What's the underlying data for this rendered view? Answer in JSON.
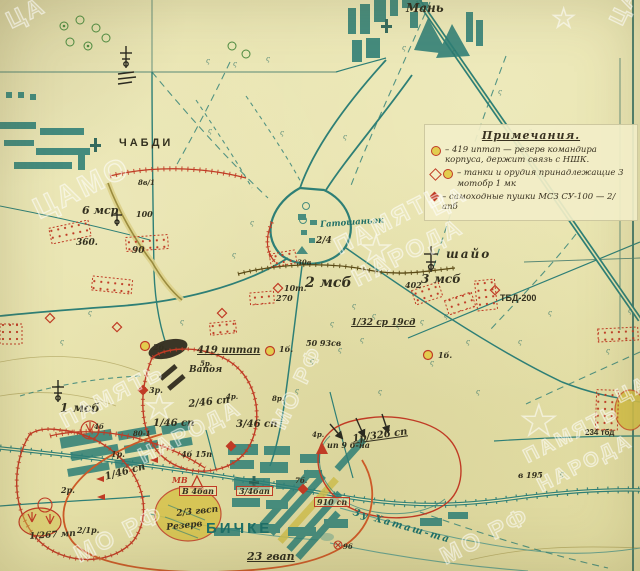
{
  "palette": {
    "dark": "#33301f",
    "teal": "#1e6e66",
    "red": "#c03b25",
    "orange": "#cc5a28",
    "brown": "#5a4a16",
    "paper": "#e8e3ac"
  },
  "legend": {
    "title": "Примечания.",
    "items": [
      {
        "symbols": [
          "sym-circle-yellow"
        ],
        "text": "– 419 иптап — резерв командира корпуса, держит связь с НШК."
      },
      {
        "symbols": [
          "sym-diamond-hollow",
          "sym-circle-yellow"
        ],
        "text": "– танки и орудия принадлежащие 3 мотобр 1 мк"
      },
      {
        "symbols": [
          "sym-diamond-solid"
        ],
        "text": "– самоходные пушки МСЗ СУ-100 — 2/апб"
      }
    ]
  },
  "labels": [
    {
      "text": "Мань",
      "x": 406,
      "y": 2,
      "size": 12,
      "color": "dark",
      "name": "town-label-man"
    },
    {
      "text": "ЧАБДИ",
      "x": 119,
      "y": 138,
      "size": 11,
      "color": "dark",
      "cls": "lab-print",
      "spacing": 3,
      "name": "town-label-chabdi"
    },
    {
      "text": "8в/1",
      "x": 138,
      "y": 179,
      "size": 7,
      "color": "dark"
    },
    {
      "text": "6 мср",
      "x": 82,
      "y": 205,
      "size": 11,
      "color": "dark",
      "name": "unit-label-6msr"
    },
    {
      "text": "100",
      "x": 136,
      "y": 210,
      "size": 8,
      "color": "dark"
    },
    {
      "text": "360.",
      "x": 76,
      "y": 239,
      "size": 9,
      "color": "dark"
    },
    {
      "text": "90",
      "x": 132,
      "y": 247,
      "size": 9,
      "color": "dark"
    },
    {
      "text": "Гатошаньэк",
      "x": 320,
      "y": 221,
      "size": 8.5,
      "color": "teal",
      "rotate": -4,
      "name": "town-label-gatoshanek"
    },
    {
      "text": "2/4",
      "x": 316,
      "y": 237,
      "size": 9,
      "color": "dark"
    },
    {
      "text": "шайо",
      "x": 446,
      "y": 248,
      "size": 12,
      "color": "dark",
      "spacing": 2,
      "name": "town-label-shayo"
    },
    {
      "text": "3 мсб",
      "x": 421,
      "y": 273,
      "size": 12,
      "color": "dark",
      "name": "unit-label-3msb"
    },
    {
      "text": "402",
      "x": 405,
      "y": 281,
      "size": 8,
      "color": "dark"
    },
    {
      "text": "ТБД-200",
      "x": 500,
      "y": 294,
      "size": 9,
      "color": "dark",
      "cls": "lab-print"
    },
    {
      "text": "2 мсб",
      "x": 305,
      "y": 276,
      "size": 14,
      "color": "dark",
      "name": "unit-label-2msb"
    },
    {
      "text": "10т.",
      "x": 284,
      "y": 284,
      "size": 8,
      "color": "dark"
    },
    {
      "text": "270",
      "x": 276,
      "y": 294,
      "size": 8,
      "color": "dark"
    },
    {
      "text": "30в",
      "x": 297,
      "y": 259,
      "size": 7,
      "color": "dark"
    },
    {
      "text": "1/32 ср 19сд",
      "x": 351,
      "y": 319,
      "size": 9,
      "color": "dark",
      "underline": true
    },
    {
      "text": "50 93св",
      "x": 306,
      "y": 339,
      "size": 8,
      "color": "dark"
    },
    {
      "text": "419 иптап",
      "x": 197,
      "y": 346,
      "size": 10,
      "color": "dark",
      "underline": true,
      "name": "unit-label-419iptap"
    },
    {
      "text": "2б.",
      "x": 153,
      "y": 343,
      "size": 8,
      "color": "dark"
    },
    {
      "text": "1б.",
      "x": 279,
      "y": 345,
      "size": 8,
      "color": "dark"
    },
    {
      "text": "1б.",
      "x": 438,
      "y": 351,
      "size": 8,
      "color": "dark"
    },
    {
      "text": "Вапоя",
      "x": 189,
      "y": 366,
      "size": 9,
      "color": "dark"
    },
    {
      "text": "3р.",
      "x": 149,
      "y": 386,
      "size": 8,
      "color": "dark"
    },
    {
      "text": "5р.",
      "x": 200,
      "y": 360,
      "size": 7,
      "color": "dark"
    },
    {
      "text": "4р.",
      "x": 226,
      "y": 393,
      "size": 7,
      "color": "dark"
    },
    {
      "text": "8р.",
      "x": 272,
      "y": 395,
      "size": 7,
      "color": "dark"
    },
    {
      "text": "1 мсб",
      "x": 60,
      "y": 402,
      "size": 12,
      "color": "dark",
      "name": "unit-label-1msb"
    },
    {
      "text": "4б",
      "x": 94,
      "y": 423,
      "size": 7,
      "color": "dark"
    },
    {
      "text": "80-1",
      "x": 133,
      "y": 430,
      "size": 7,
      "color": "dark"
    },
    {
      "text": "1р.",
      "x": 111,
      "y": 450,
      "size": 8,
      "color": "dark"
    },
    {
      "text": "2/46 сп",
      "x": 188,
      "y": 400,
      "size": 10,
      "color": "dark",
      "rotate": -6
    },
    {
      "text": "1/46 сп",
      "x": 153,
      "y": 419,
      "size": 10,
      "color": "dark"
    },
    {
      "text": "3/46 сп",
      "x": 236,
      "y": 420,
      "size": 10,
      "color": "dark"
    },
    {
      "text": "4б 15п",
      "x": 181,
      "y": 450,
      "size": 8,
      "color": "dark"
    },
    {
      "text": "4р.",
      "x": 312,
      "y": 431,
      "size": 7,
      "color": "dark"
    },
    {
      "text": "ип 9 б-на",
      "x": 327,
      "y": 441,
      "size": 8,
      "color": "dark"
    },
    {
      "text": "1р/326 сп",
      "x": 352,
      "y": 435,
      "size": 10,
      "color": "dark",
      "rotate": -8,
      "underline": true
    },
    {
      "text": "7б.",
      "x": 295,
      "y": 477,
      "size": 7,
      "color": "dark"
    },
    {
      "text": "МВ",
      "x": 172,
      "y": 476,
      "size": 8,
      "color": "red"
    },
    {
      "text": "В 4бап",
      "x": 179,
      "y": 486,
      "size": 8,
      "color": "dark",
      "boxed": true
    },
    {
      "text": "3/4бап",
      "x": 236,
      "y": 486,
      "size": 8,
      "color": "dark",
      "boxed": true
    },
    {
      "text": "910 сп",
      "x": 314,
      "y": 497,
      "size": 8,
      "color": "dark",
      "boxed": true
    },
    {
      "text": "2/3 гвсп",
      "x": 176,
      "y": 510,
      "size": 9,
      "color": "dark",
      "rotate": -6
    },
    {
      "text": "Резерв",
      "x": 166,
      "y": 524,
      "size": 9,
      "color": "dark",
      "rotate": -6
    },
    {
      "text": "БИЧКЕ",
      "x": 206,
      "y": 521,
      "size": 15,
      "color": "teal",
      "cls": "lab-print",
      "spacing": 3,
      "name": "town-label-bicske"
    },
    {
      "text": "23 гвап",
      "x": 247,
      "y": 551,
      "size": 11,
      "color": "dark",
      "underline": true,
      "name": "unit-label-23gvap"
    },
    {
      "text": "1/46 сп",
      "x": 104,
      "y": 473,
      "size": 10,
      "color": "dark",
      "rotate": -15
    },
    {
      "text": "2р.",
      "x": 61,
      "y": 486,
      "size": 8,
      "color": "dark"
    },
    {
      "text": "2/1р.",
      "x": 77,
      "y": 526,
      "size": 8,
      "color": "dark"
    },
    {
      "text": "1/267 мп",
      "x": 29,
      "y": 533,
      "size": 9,
      "color": "dark",
      "rotate": -4,
      "name": "unit-label-267mp"
    },
    {
      "text": "Зу Хаташ-та",
      "x": 354,
      "y": 508,
      "size": 10,
      "color": "teal",
      "rotate": 16,
      "spacing": 2,
      "name": "stream-label"
    },
    {
      "text": "96",
      "x": 343,
      "y": 543,
      "size": 7,
      "color": "dark"
    },
    {
      "text": "234 тбд",
      "x": 585,
      "y": 429,
      "size": 8,
      "color": "dark",
      "cls": "lab-print"
    },
    {
      "text": "в 195",
      "x": 518,
      "y": 471,
      "size": 8,
      "color": "dark"
    }
  ],
  "terrain_marks": {
    "glyph": "ς",
    "size": 7,
    "positions": [
      [
        206,
        57
      ],
      [
        233,
        60
      ],
      [
        266,
        55
      ],
      [
        208,
        127
      ],
      [
        280,
        129
      ],
      [
        343,
        133
      ],
      [
        402,
        44
      ],
      [
        452,
        48
      ],
      [
        498,
        88
      ],
      [
        528,
        127
      ],
      [
        556,
        166
      ],
      [
        352,
        302
      ],
      [
        372,
        312
      ],
      [
        396,
        322
      ],
      [
        420,
        318
      ],
      [
        444,
        312
      ],
      [
        466,
        338
      ],
      [
        518,
        338
      ],
      [
        606,
        347
      ],
      [
        628,
        307
      ],
      [
        180,
        318
      ],
      [
        88,
        309
      ],
      [
        60,
        338
      ],
      [
        250,
        219
      ],
      [
        232,
        251
      ],
      [
        330,
        320
      ],
      [
        310,
        357
      ],
      [
        295,
        387
      ],
      [
        378,
        388
      ],
      [
        476,
        388
      ],
      [
        548,
        309
      ],
      [
        560,
        470
      ],
      [
        430,
        359
      ],
      [
        338,
        346
      ],
      [
        360,
        336
      ]
    ]
  },
  "watermarks": {
    "texts": [
      {
        "t": "ЦА",
        "x": 2,
        "y": 10,
        "r": -26,
        "s": 24
      },
      {
        "t": "ЦАМО",
        "x": 28,
        "y": 196,
        "r": -26,
        "s": 30
      },
      {
        "t": "ПАМЯТЬ",
        "x": 330,
        "y": 236,
        "r": -27,
        "s": 24
      },
      {
        "t": "НАРОДА",
        "x": 348,
        "y": 268,
        "r": -27,
        "s": 24
      },
      {
        "t": "ЦА",
        "x": 426,
        "y": 198,
        "r": -27,
        "s": 22
      },
      {
        "t": "МО РФ",
        "x": 266,
        "y": 422,
        "r": -64,
        "s": 22
      },
      {
        "t": "ПАМЯТЬ",
        "x": 56,
        "y": 410,
        "r": -27,
        "s": 22
      },
      {
        "t": "НАРОДА",
        "x": 134,
        "y": 446,
        "r": -27,
        "s": 22
      },
      {
        "t": "МО РФ",
        "x": 70,
        "y": 544,
        "r": -27,
        "s": 24
      },
      {
        "t": "ПАМЯТЬ",
        "x": 520,
        "y": 448,
        "r": -27,
        "s": 20
      },
      {
        "t": "НАРОДА",
        "x": 534,
        "y": 477,
        "r": -27,
        "s": 20
      },
      {
        "t": "МО РФ",
        "x": 436,
        "y": 546,
        "r": -27,
        "s": 24
      },
      {
        "t": "ЦА",
        "x": 612,
        "y": 388,
        "r": -27,
        "s": 20
      },
      {
        "t": "ЦАМ",
        "x": 604,
        "y": 18,
        "r": -64,
        "s": 22
      }
    ],
    "stars": [
      {
        "x": 360,
        "y": 232,
        "s": 36
      },
      {
        "x": 520,
        "y": 400,
        "s": 42
      },
      {
        "x": 144,
        "y": 390,
        "s": 34
      },
      {
        "x": 552,
        "y": 6,
        "s": 26
      }
    ],
    "star_glyph": "★"
  }
}
